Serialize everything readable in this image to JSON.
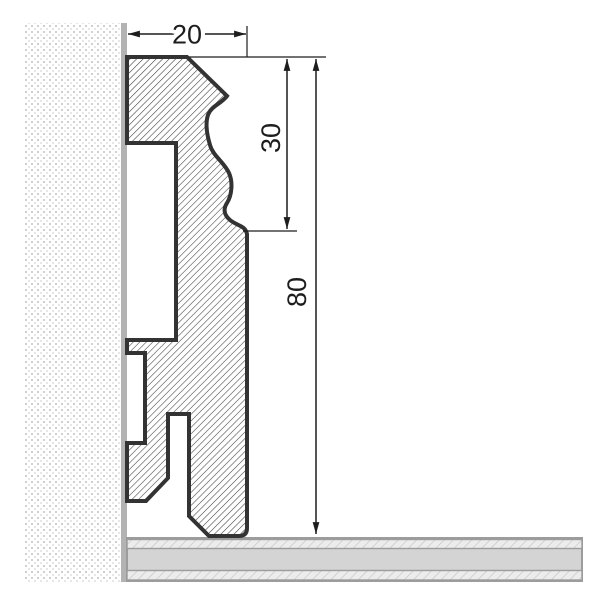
{
  "diagram": {
    "kind": "skirting-profile-cross-section",
    "dims": {
      "width": "20",
      "upper_height": "30",
      "total_height": "80"
    },
    "colors": {
      "background": "#ffffff",
      "outline": "#333333",
      "hatch_line": "#3c3c3c",
      "dim_line": "#1d1d1d",
      "text": "#1d1d1d",
      "wall_edge": "#b3b3b3",
      "wall_dot_a": "#d0d0d0",
      "wall_dot_b": "#e7e7e7",
      "floor_fill": "#d4d4d4",
      "floor_line": "#9c9c9c",
      "floor_hatch_bg": "#ececec",
      "floor_hatch_line": "#c3c3c3"
    }
  }
}
